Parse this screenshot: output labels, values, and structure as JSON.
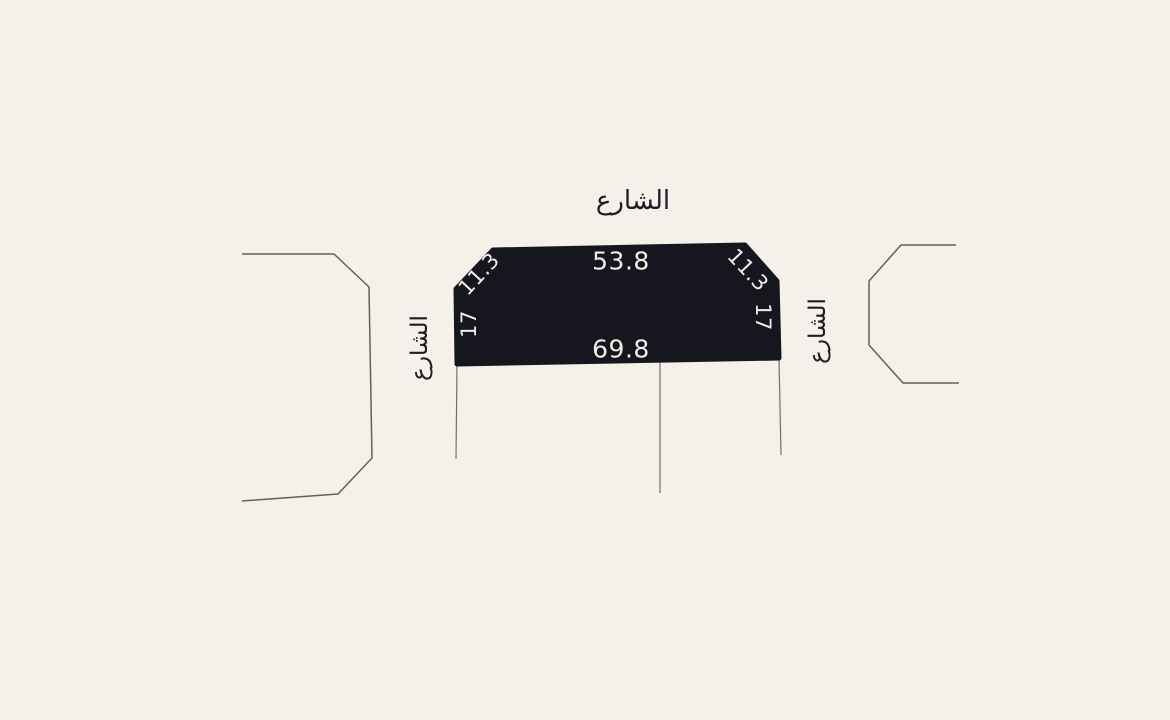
{
  "canvas": {
    "width": 1170,
    "height": 720
  },
  "colors": {
    "background": "#F5F0E9",
    "parcel_fill": "#16161F",
    "parcel_dimension_text": "#F0EDE5",
    "street_label_text": "#1C1C26",
    "neighbor_outline_line": "#63605A",
    "boundary_extension_line": "#73706A"
  },
  "street_labels": {
    "top": "الشارع",
    "left": "الشارع",
    "right": "الشارع"
  },
  "parcel": {
    "dimension_labels": {
      "top_edge": "53.8",
      "bottom_edge": "69.8",
      "top_left_chamfer": "11.3",
      "top_right_chamfer": "11.3",
      "left_edge": "17",
      "right_edge": "17"
    }
  }
}
